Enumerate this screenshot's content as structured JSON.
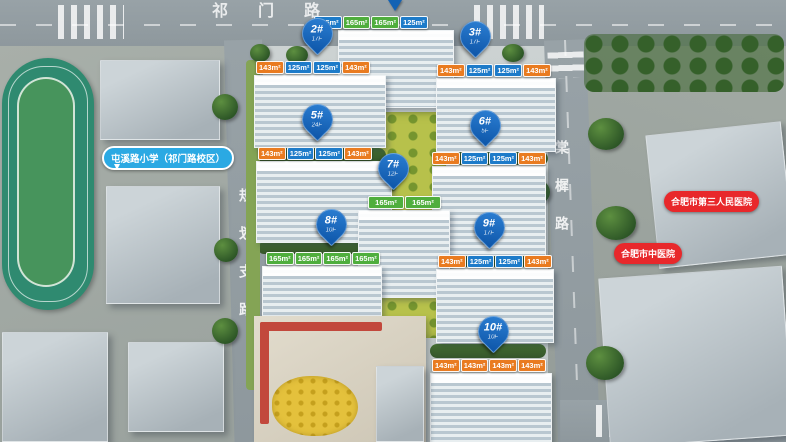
{
  "roads": {
    "top": "祁门路",
    "left": "规划支路",
    "right": "棠樨路"
  },
  "landmarks": {
    "school": "屯溪路小学（祁门路校区）",
    "hospital_third": "合肥市第三人民医院",
    "hospital_tcm": "合肥市中医院"
  },
  "pins": {
    "b2": {
      "no": "2#",
      "floors": "17F"
    },
    "b3": {
      "no": "3#",
      "floors": "17F"
    },
    "b5": {
      "no": "5#",
      "floors": "24F"
    },
    "b6": {
      "no": "6#",
      "floors": "5F"
    },
    "b7": {
      "no": "7#",
      "floors": "12F"
    },
    "b8": {
      "no": "8#",
      "floors": "10F"
    },
    "b9": {
      "no": "9#",
      "floors": "17F"
    },
    "b10": {
      "no": "10#",
      "floors": "10F"
    }
  },
  "tags": {
    "b1": [
      "125m²",
      "165m²",
      "165m²",
      "125m²"
    ],
    "b2": [
      "143m²",
      "125m²",
      "125m²",
      "143m²"
    ],
    "b3": [
      "143m²",
      "125m²",
      "125m²",
      "143m²"
    ],
    "b5": [
      "143m²",
      "125m²",
      "125m²",
      "143m²"
    ],
    "b6": [
      "143m²",
      "125m²",
      "125m²",
      "143m²"
    ],
    "b7": [
      "165m²",
      "165m²"
    ],
    "b8": [
      "165m²",
      "165m²",
      "165m²",
      "165m²"
    ],
    "b9": [
      "143m²",
      "125m²",
      "125m²",
      "143m²"
    ],
    "b10": [
      "143m²",
      "143m²",
      "143m²",
      "143m²"
    ]
  },
  "colors": {
    "pin_blue": "#1668c4",
    "tag_orange": "#e97b20",
    "tag_blue": "#1d7bc9",
    "tag_green": "#4fae3d",
    "bubble_red": "#e8282b",
    "school_pill_blue": "#2ba9e3"
  }
}
